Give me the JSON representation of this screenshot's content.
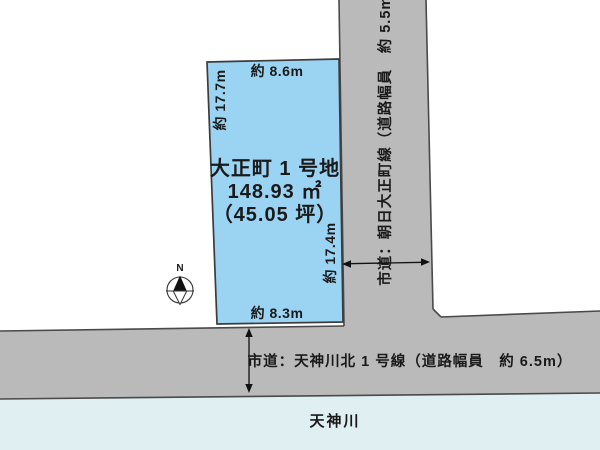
{
  "plot": {
    "name": "大正町 1 号地",
    "area_m2": "148.93 ㎡",
    "area_tsubo": "（45.05 坪）",
    "dim_top": "約 8.6m",
    "dim_left": "約 17.7m",
    "dim_right": "約 17.4m",
    "dim_bottom": "約 8.3m",
    "fill_color": "#9bd3f3"
  },
  "roads": {
    "vertical": {
      "label": "市道：朝日大正町線（道路幅員　約 5.5m）"
    },
    "horizontal": {
      "label": "市道：天神川北 1 号線（道路幅員　約 6.5m）"
    },
    "fill_color": "#bababa",
    "edge_color": "#4a4a4a"
  },
  "river": {
    "label": "天神川",
    "fill_color": "#e0eff2"
  },
  "compass": {
    "label": "N"
  }
}
